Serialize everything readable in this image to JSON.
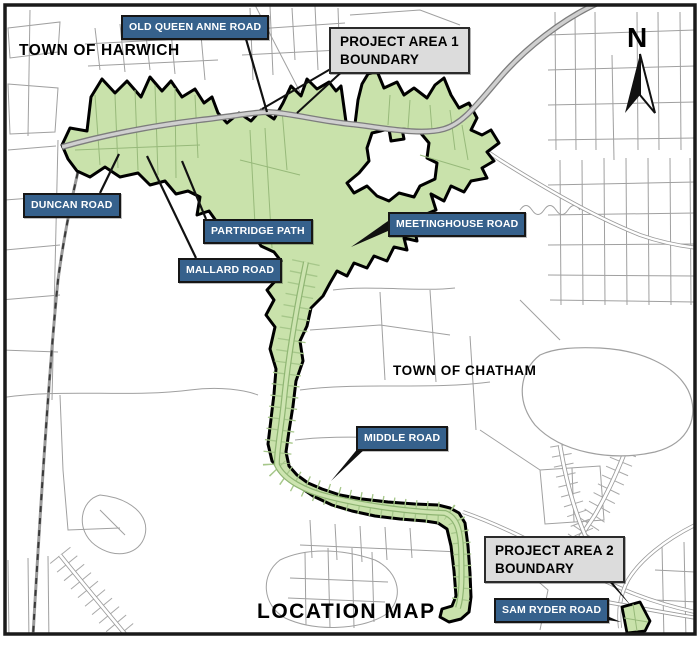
{
  "figure": {
    "title": "LOCATION MAP",
    "north_label": "N"
  },
  "towns": {
    "harwich": "TOWN OF HARWICH",
    "chatham": "TOWN OF CHATHAM"
  },
  "boundary_labels": {
    "area1": "PROJECT AREA 1\nBOUNDARY",
    "area2": "PROJECT AREA 2\nBOUNDARY"
  },
  "road_labels": {
    "old_queen_anne": "OLD QUEEN ANNE ROAD",
    "duncan": "DUNCAN ROAD",
    "partridge": "PARTRIDGE PATH",
    "mallard": "MALLARD ROAD",
    "meetinghouse": "MEETINGHOUSE ROAD",
    "middle": "MIDDLE ROAD",
    "sam_ryder": "SAM RYDER ROAD"
  },
  "legend_colors": {
    "project_area_fill": "#c9e2ab",
    "project_area_outline": "#000000",
    "road_label_bg": "#36618c",
    "road_label_text": "#ffffff",
    "boundary_label_bg": "#dcdcdc",
    "boundary_label_text": "#000000"
  }
}
